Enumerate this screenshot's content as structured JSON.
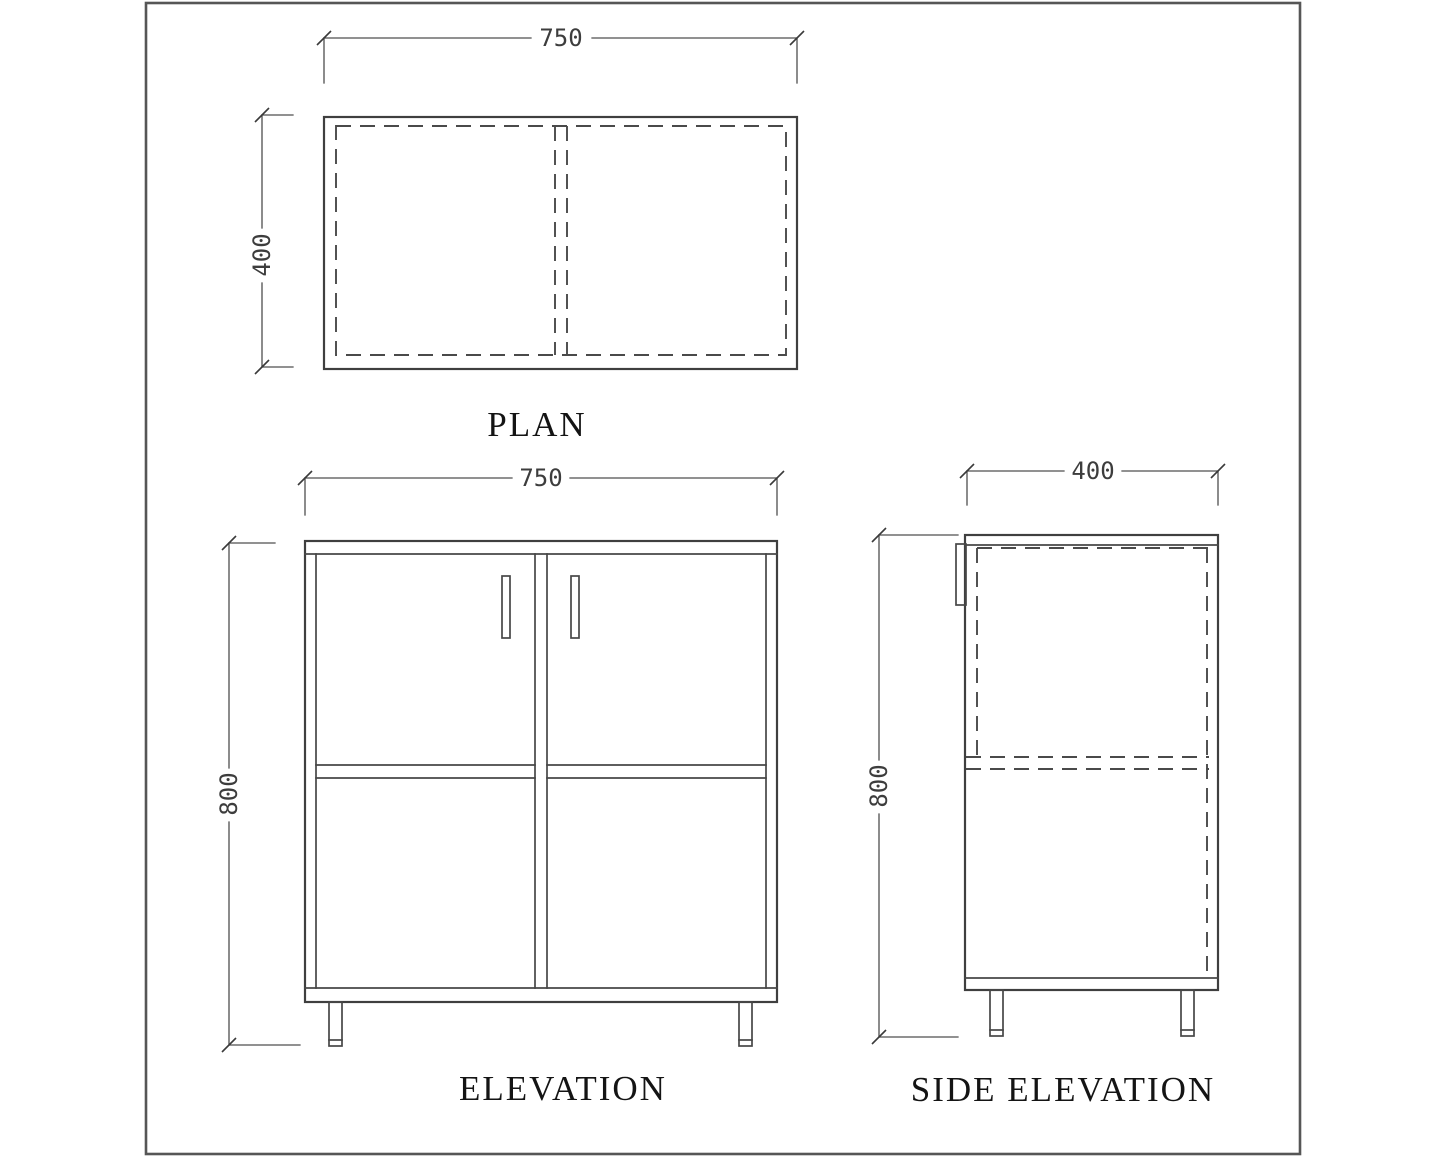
{
  "page": {
    "background_color": "#ffffff",
    "line_color": "#3f3f3f",
    "frame_color": "#565656",
    "text_color": "#141414"
  },
  "plan": {
    "label": "PLAN",
    "width": "750",
    "depth": "400"
  },
  "elevation": {
    "label": "ELEVATION",
    "width": "750",
    "height": "800"
  },
  "side_elevation": {
    "label": "SIDE ELEVATION",
    "width": "400",
    "height": "800"
  }
}
